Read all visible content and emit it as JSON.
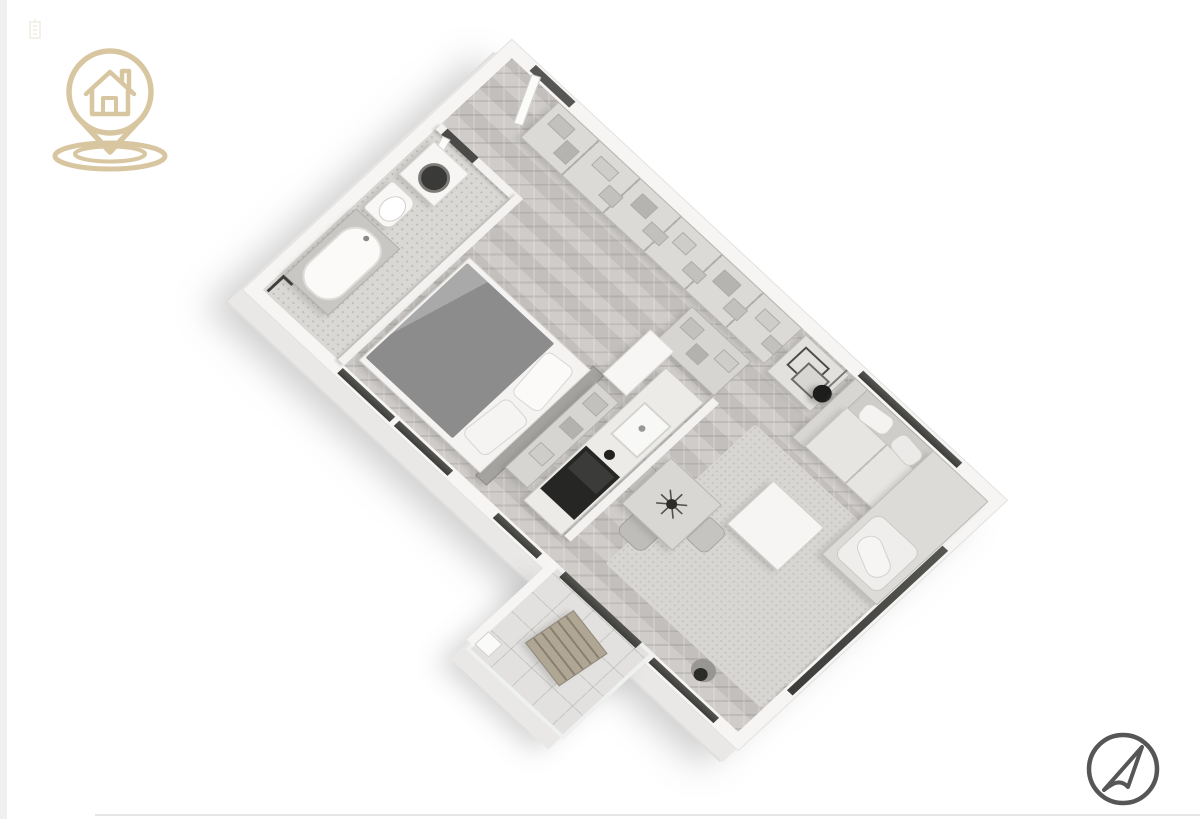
{
  "page": {
    "background": "#ffffff",
    "left_strip_color": "#f0f0ef",
    "bottom_rule_color": "#e5e5e3"
  },
  "branding": {
    "logo_icon": "house-location-pin-icon",
    "logo_color": "#d8c6a1",
    "logo_label": "House location pin logo",
    "watermark_icon": "building-watermark-icon",
    "watermark_color": "#e6e0d0",
    "watermark_label": "Faint watermark glyph"
  },
  "compass": {
    "icon": "navigation-arrow-icon",
    "stroke_color": "#565656",
    "pointing": "northeast",
    "label": "Compass / orientation arrow"
  },
  "floor_plan": {
    "style": "3d-isometric-apartment-render",
    "rotation_deg": 45,
    "label": "Studio apartment 3D floor plan",
    "palette": {
      "outer_wall": "#f6f5f4",
      "wall_edge": "#e3e2e0",
      "floor_wood_herringbone": "#ccc9c6",
      "floor_bathroom": "#dad8d4",
      "window_glass": "#454543",
      "furniture_light": "#f7f6f4",
      "furniture_mid": "#c9c7c4",
      "bed_duvet": "#8c8c8c",
      "accent_dark": "#262626",
      "balcony_wood": "#b0a694"
    },
    "rooms": {
      "bathroom": {
        "label": "Bathroom",
        "furniture": [
          "washing machine",
          "toilet",
          "bathtub vanity",
          "shower fixture",
          "door"
        ]
      },
      "bedroom": {
        "label": "Bedroom",
        "furniture": [
          "double bed",
          "duvet",
          "pillows",
          "headboard panel",
          "tall cabinet",
          "open shelves"
        ]
      },
      "kitchen": {
        "label": "Kitchen",
        "furniture": [
          "counter",
          "sink",
          "cooktop",
          "black oven front",
          "pantry shelves"
        ]
      },
      "living": {
        "label": "Living / Dining",
        "furniture": [
          "corner sofa",
          "cushions",
          "coffee table",
          "rug",
          "dining table",
          "dining chairs",
          "arc floor lamp",
          "plant"
        ]
      },
      "hall": {
        "label": "Hall",
        "furniture": [
          "entry door",
          "built-in wardrobe",
          "console with frames"
        ]
      },
      "balcony": {
        "label": "Balcony",
        "furniture": [
          "wooden slat chair",
          "glass railing",
          "side stool"
        ]
      }
    },
    "openings": {
      "windows": [
        "bedroom window (SW wall)",
        "kitchen window (SW wall)",
        "living window (SW wall)",
        "sofa window (NE wall)",
        "corner window (SE wall)",
        "balcony sliding door"
      ],
      "doors": [
        "entry door (NE wall)",
        "bathroom door"
      ]
    }
  }
}
